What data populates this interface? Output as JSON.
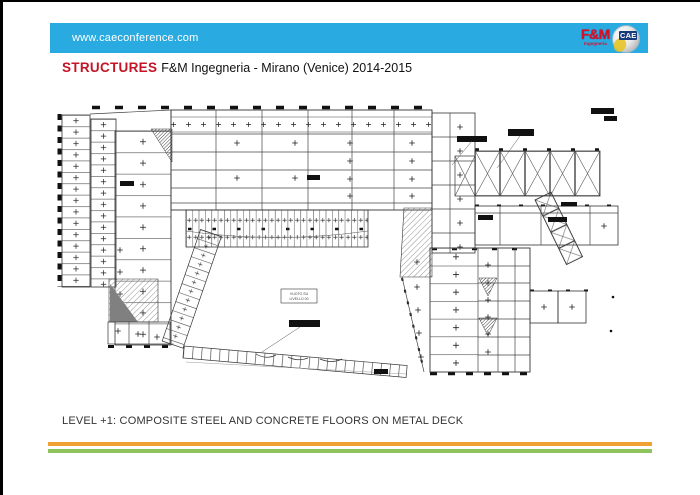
{
  "slide": {
    "header": {
      "url": "www.caeconference.com"
    },
    "logos": {
      "fm_main": "F&M",
      "fm_sub": "Ingegneria",
      "cae": "CAE"
    },
    "title": {
      "lead": "STRUCTURES",
      "rest": "F&M Ingegneria - Mirano (Venice) 2014-2015"
    },
    "plan": {
      "void_label_line1": "VUOTO SU",
      "void_label_line2": "LIVELLO 00"
    },
    "caption": "LEVEL +1: COMPOSITE STEEL AND CONCRETE FLOORS ON METAL DECK",
    "colors": {
      "bar_blue": "#29abe2",
      "title_red": "#c41425",
      "logo_red": "#d8112b",
      "stripe_orange": "#efa233",
      "stripe_green": "#8fc35d"
    }
  }
}
